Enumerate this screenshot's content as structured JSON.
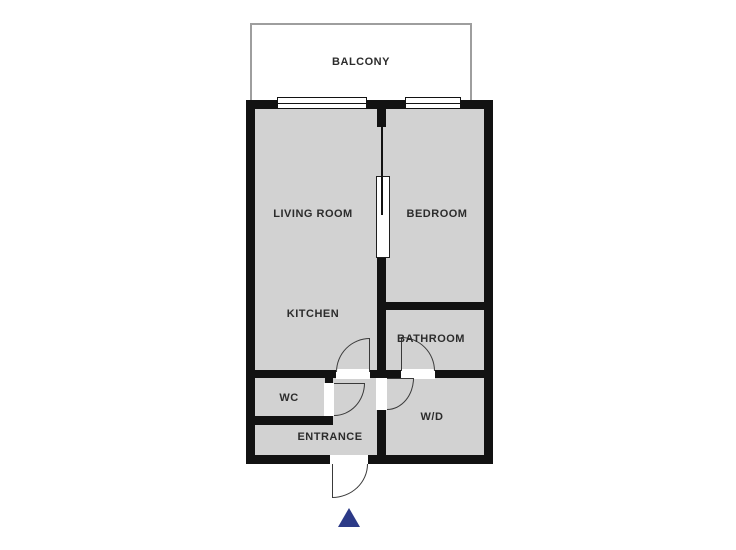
{
  "floorplan": {
    "balcony": {
      "label": "BALCONY"
    },
    "rooms": [
      {
        "name": "living-room",
        "label": "LIVING ROOM"
      },
      {
        "name": "bedroom",
        "label": "BEDROOM"
      },
      {
        "name": "kitchen",
        "label": "KITCHEN"
      },
      {
        "name": "bathroom",
        "label": "BATHROOM"
      },
      {
        "name": "wc",
        "label": "WC"
      },
      {
        "name": "entrance",
        "label": "ENTRANCE"
      },
      {
        "name": "washer-dryer",
        "label": "W/D"
      }
    ],
    "features": {
      "windows": 2,
      "hinged_door_arcs": 5,
      "sliding_doors": 1,
      "orientation_arrow": "triangle-up"
    },
    "colors": {
      "wall": "#121212",
      "room_fill": "#d2d2d2",
      "balcony_border": "#9e9e9e",
      "door_arc": "#3a3a3a",
      "label_text": "#2c2c2c",
      "north_arrow": "#2c3a87",
      "background": "#ffffff"
    }
  }
}
